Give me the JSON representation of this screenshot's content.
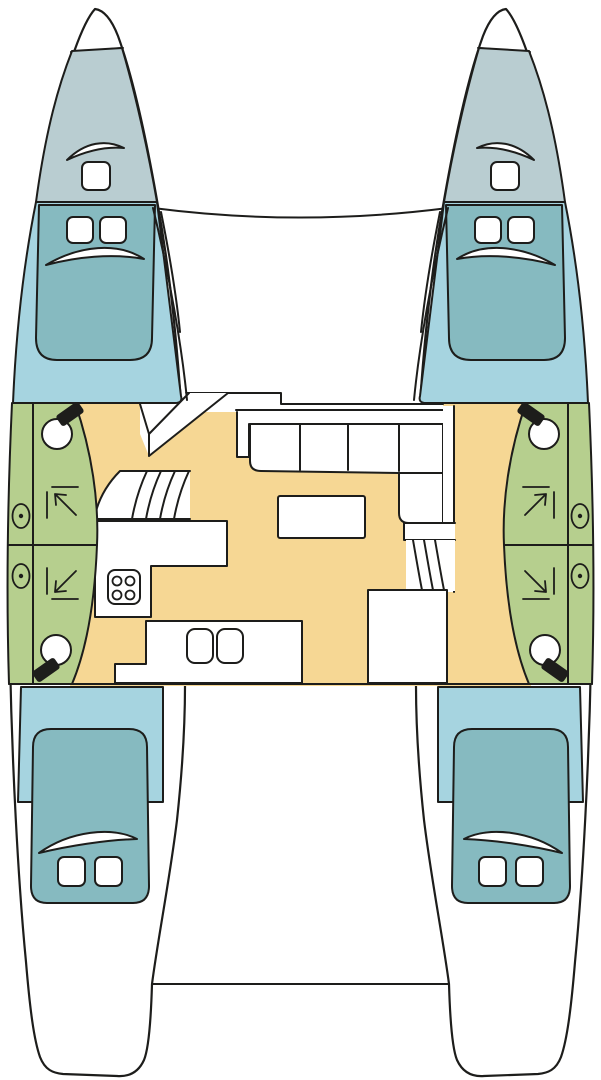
{
  "meta": {
    "title": "Catamaran interior layout plan (top-down deck view)",
    "note": "vector boat floor plan, no text labels rendered in source image"
  },
  "colors": {
    "outline": "#1d1d1b",
    "deck": "#ffffff",
    "forepeak": "#b9cdd1",
    "cabin_floor": "#a6d4e0",
    "berth": "#86bac0",
    "bathroom": "#b6cf8e",
    "salon_floor": "#f6d794",
    "fixture_black": "#1d1d1b"
  },
  "inventory": {
    "hulls": [
      "port",
      "starboard"
    ],
    "rooms": [
      {
        "id": "port-forepeak",
        "type": "forepeak-locker",
        "features": [
          "deck-hatch",
          "hatch-shade"
        ]
      },
      {
        "id": "starboard-forepeak",
        "type": "forepeak-locker",
        "features": [
          "deck-hatch",
          "hatch-shade"
        ]
      },
      {
        "id": "port-forward-cabin",
        "type": "double-berth-cabin",
        "features": [
          "double-berth",
          "2-pillows",
          "blanket-fold"
        ]
      },
      {
        "id": "starboard-forward-cabin",
        "type": "double-berth-cabin",
        "features": [
          "double-berth",
          "2-pillows",
          "blanket-fold"
        ]
      },
      {
        "id": "port-forward-bathroom",
        "type": "head",
        "features": [
          "toilet",
          "shower-corner",
          "porthole"
        ]
      },
      {
        "id": "port-aft-bathroom",
        "type": "head",
        "features": [
          "toilet",
          "shower-corner",
          "porthole"
        ]
      },
      {
        "id": "starboard-forward-bathroom",
        "type": "head",
        "features": [
          "toilet",
          "shower-corner",
          "porthole"
        ]
      },
      {
        "id": "starboard-aft-bathroom",
        "type": "head",
        "features": [
          "toilet",
          "shower-corner",
          "porthole"
        ]
      },
      {
        "id": "salon",
        "type": "salon-galley",
        "features": [
          "l-shaped-sofa-4-seats",
          "table",
          "galley-counter",
          "stove-4-burners",
          "double-sink",
          "chart-area",
          "port-stairs",
          "starboard-stairs",
          "companionway"
        ]
      },
      {
        "id": "port-aft-cabin",
        "type": "double-berth-cabin",
        "features": [
          "double-berth",
          "2-pillows",
          "blanket-fold"
        ]
      },
      {
        "id": "starboard-aft-cabin",
        "type": "double-berth-cabin",
        "features": [
          "double-berth",
          "2-pillows",
          "blanket-fold"
        ]
      },
      {
        "id": "foredeck",
        "type": "deck"
      },
      {
        "id": "cockpit",
        "type": "aft-deck-transoms"
      }
    ],
    "counts": {
      "toilets": 4,
      "showers": 4,
      "portholes": 4,
      "berths": 4,
      "deck_hatches": 2,
      "sofa_seats": 4,
      "stove_burners": 4,
      "sinks": 2
    }
  }
}
